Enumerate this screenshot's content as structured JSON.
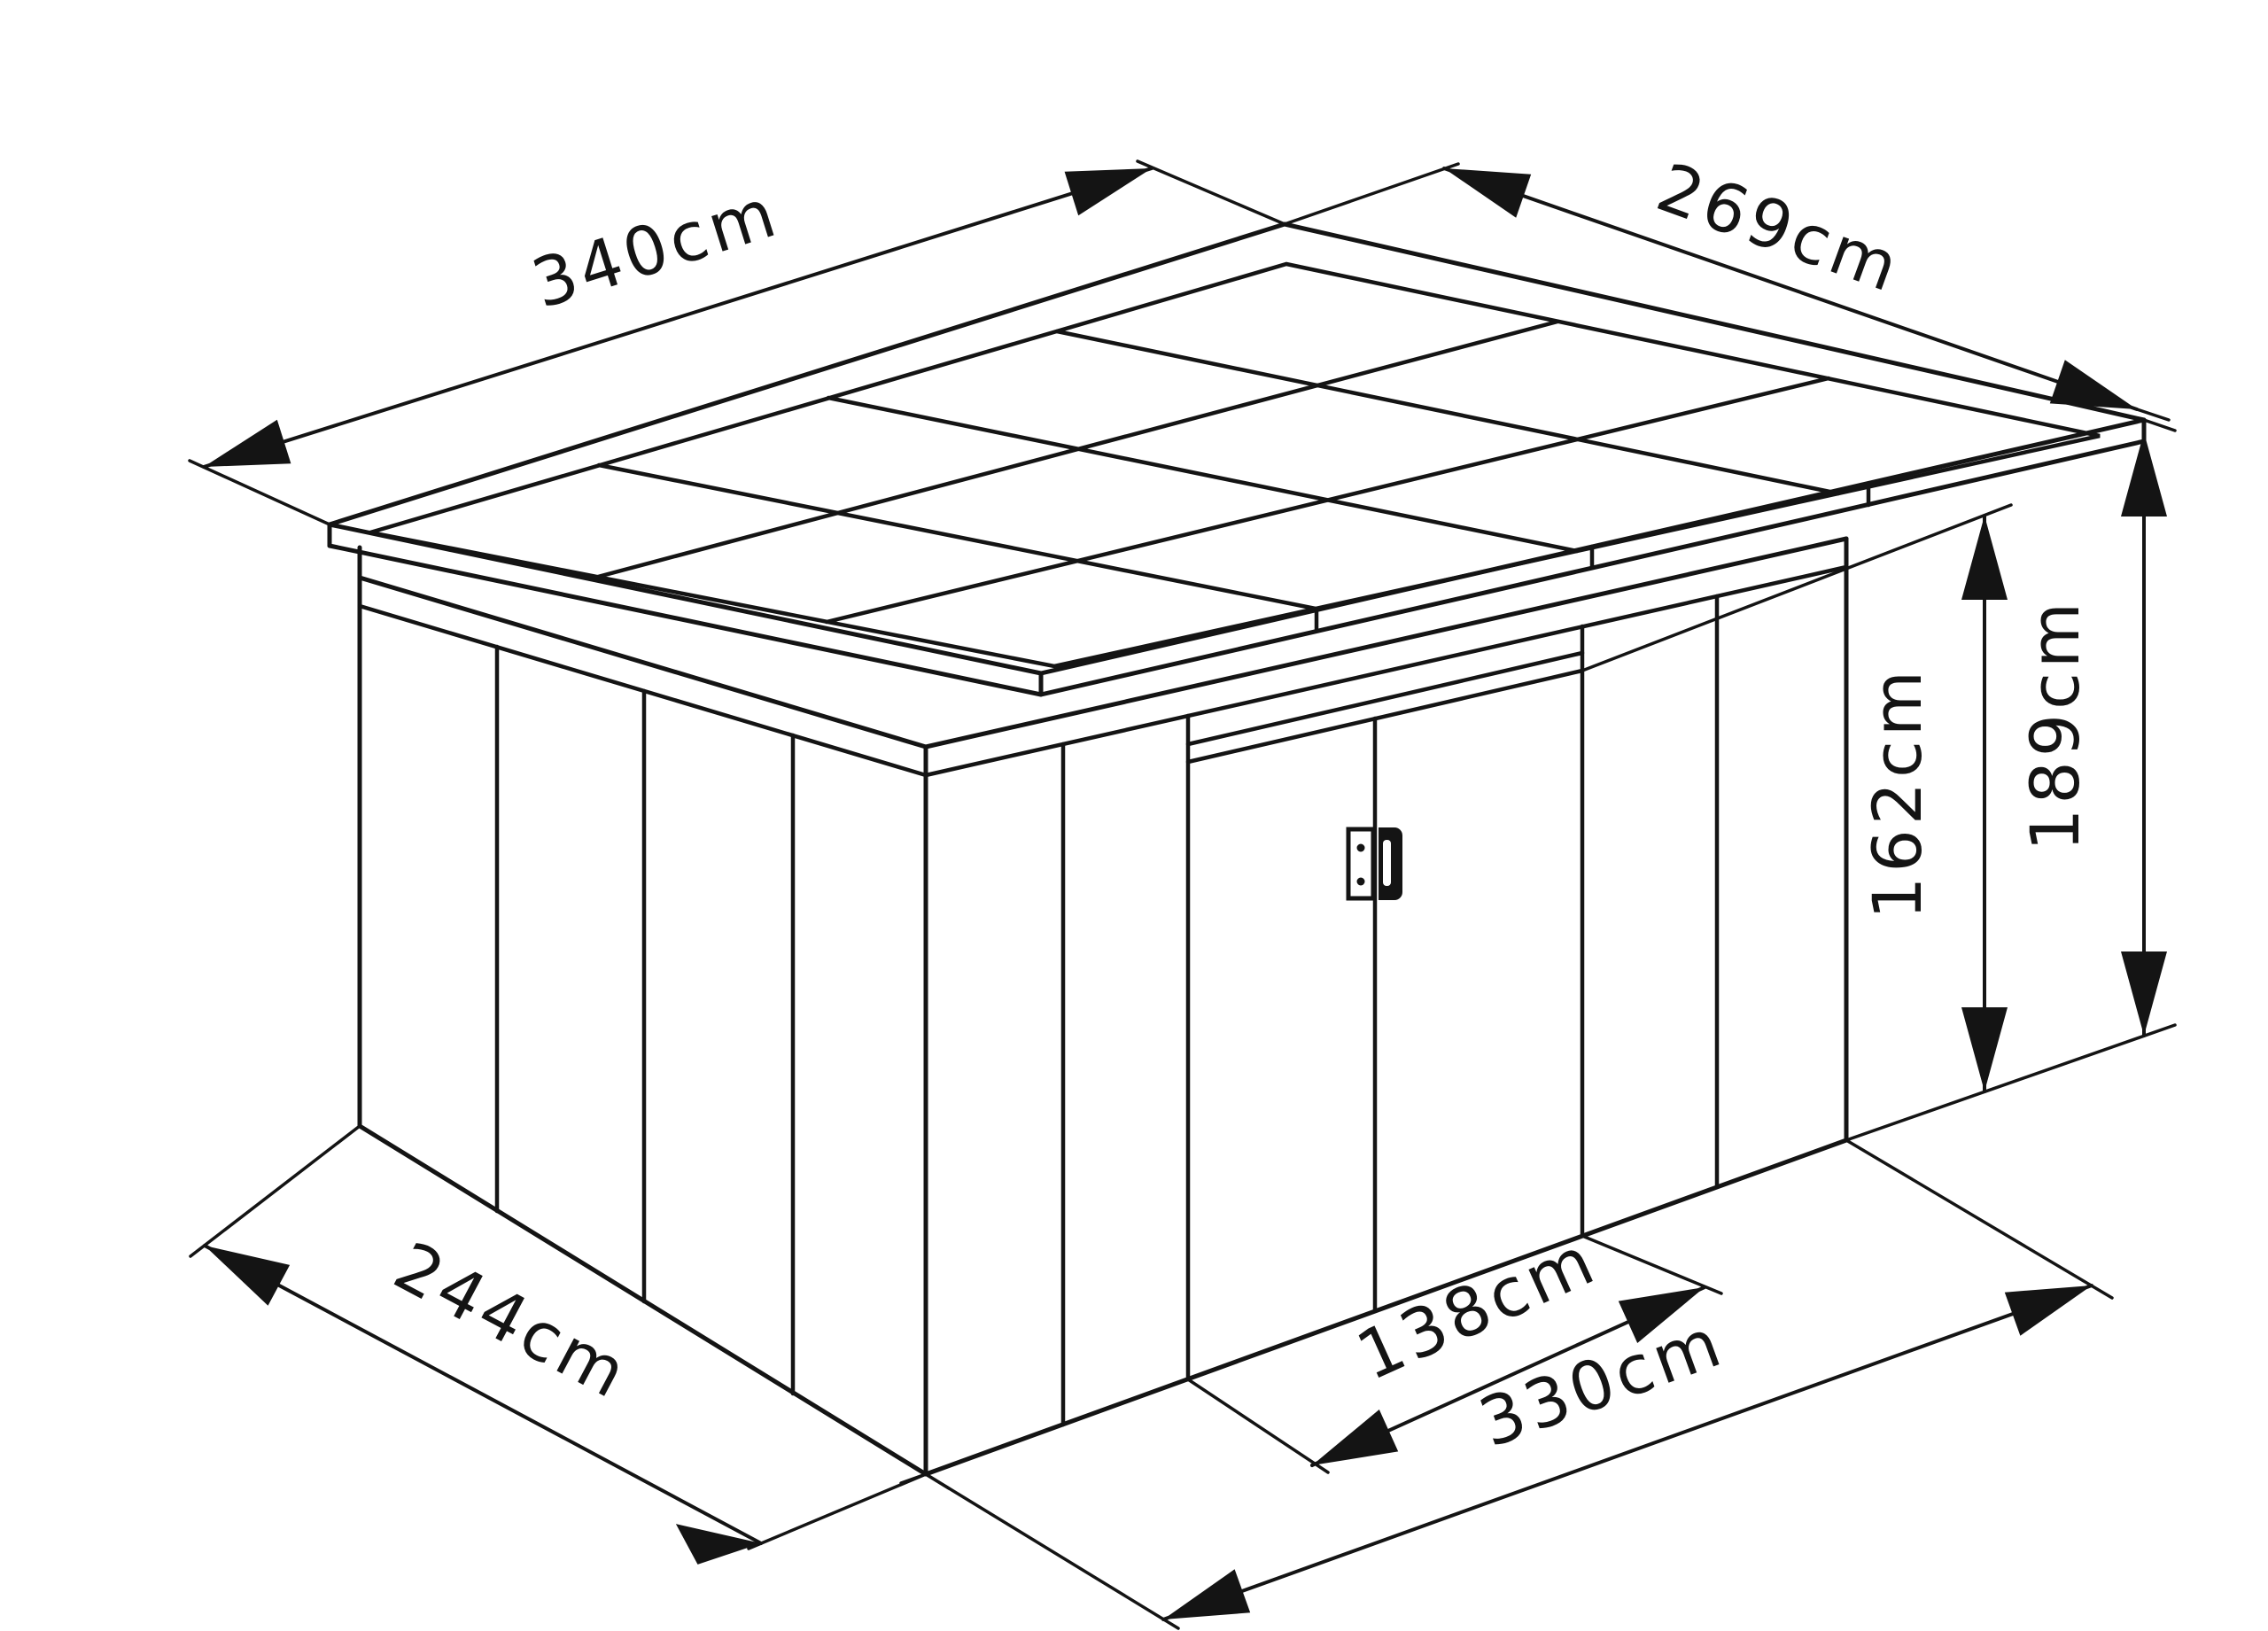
{
  "drawing": {
    "background_color": "#ffffff",
    "line_color": "#141414",
    "subject": "garden shed isometric dimension drawing",
    "labels": {
      "roof_length": "340cm",
      "roof_depth": "269cm",
      "base_depth": "244cm",
      "base_length": "330cm",
      "door_width": "138cm",
      "door_height": "162cm",
      "overall_height": "189cm"
    }
  }
}
